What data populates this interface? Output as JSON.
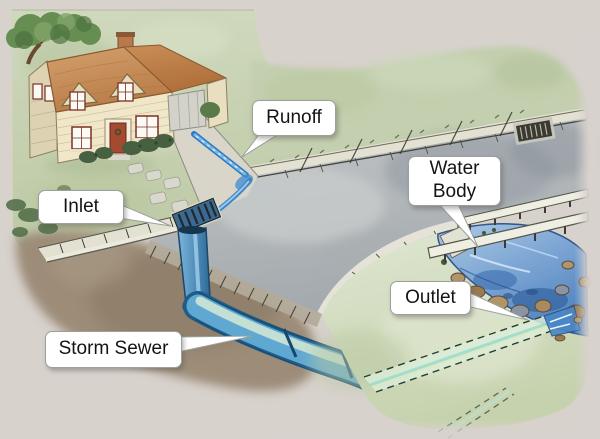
{
  "callouts": {
    "runoff": {
      "label": "Runoff"
    },
    "inlet": {
      "label": "Inlet"
    },
    "water_body": {
      "label": "Water Body"
    },
    "outlet": {
      "label": "Outlet"
    },
    "storm_sewer": {
      "label": "Storm Sewer"
    }
  },
  "colors": {
    "background": "#d8d2cd",
    "label_bg": "#ffffff",
    "label_border": "#9aa09e",
    "label_text": "#141414",
    "grass": "#c9d3b4",
    "grass_far": "#c3cfae",
    "bank": "#d5decb",
    "tree": "#678e52",
    "dirt": "#9c8c78",
    "street": "#b7babc",
    "sidewalk": "#e2e1d2",
    "curb": "#ece9dd",
    "roof": "#cd9662",
    "roof_wing": "#c2834e",
    "wall": "#f0e7c9",
    "wall_shade": "#ddd3b2",
    "window_frame": "#7a3028",
    "door": "#a34a30",
    "garage_door": "#d3d2c9",
    "bush": "#47603f",
    "driveway": "#d9d5c9",
    "runoff_water": "#2d7ac2",
    "pipe": "#5fa8d2",
    "pipe_dark": "#1f5c88",
    "pipe_highlight": "#cfe6d4",
    "stream": "#5b97cf",
    "stream_deep": "#33639f",
    "bridge": "#efeee3",
    "rock": "#b2946a",
    "grate": "#3a3a32"
  }
}
